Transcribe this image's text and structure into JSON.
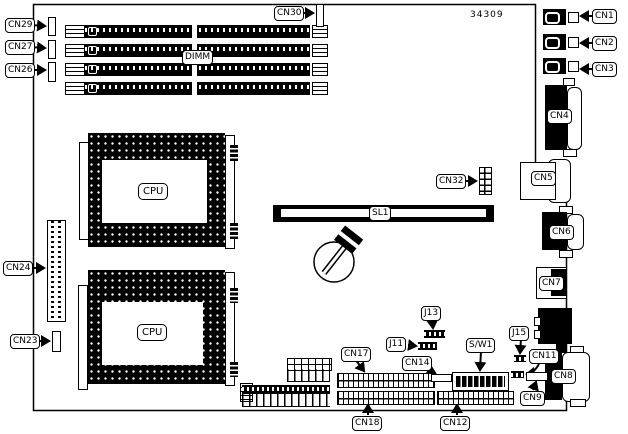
{
  "board": {
    "part_number": "34309"
  },
  "labels": {
    "cn1": "CN1",
    "cn2": "CN2",
    "cn3": "CN3",
    "cn4": "CN4",
    "cn5": "CN5",
    "cn6": "CN6",
    "cn7": "CN7",
    "cn8": "CN8",
    "cn9": "CN9",
    "cn11": "CN11",
    "cn12": "CN12",
    "cn14": "CN14",
    "cn17": "CN17",
    "cn18": "CN18",
    "cn23": "CN23",
    "cn24": "CN24",
    "cn26": "CN26",
    "cn27": "CN27",
    "cn29": "CN29",
    "cn30": "CN30",
    "cn32": "CN32",
    "j11": "J11",
    "j13": "J13",
    "j15": "J15",
    "sw1": "S/W1",
    "sl1": "SL1",
    "dimm": "DIMM",
    "cpu": "CPU"
  }
}
